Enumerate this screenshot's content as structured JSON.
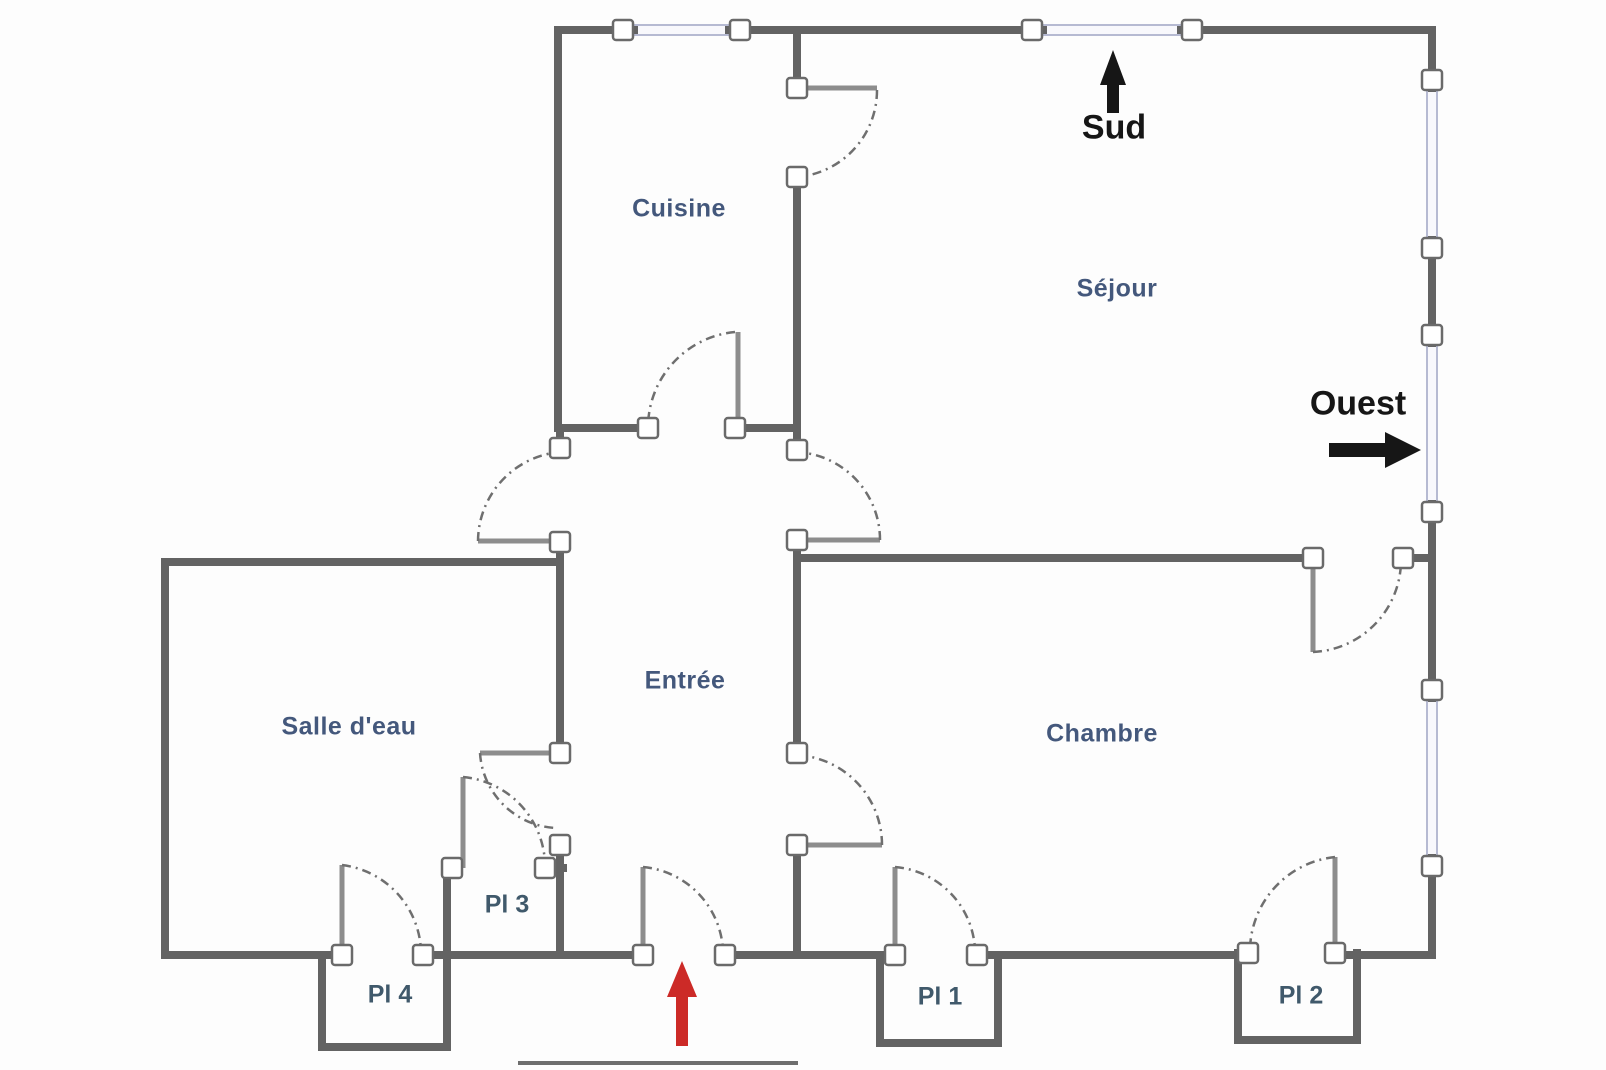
{
  "plan_title": "Apartment floor plan",
  "rooms": {
    "cuisine": "Cuisine",
    "sejour": "Séjour",
    "salle_eau": "Salle d'eau",
    "entree": "Entrée",
    "chambre": "Chambre"
  },
  "closets": {
    "pl1": "Pl 1",
    "pl2": "Pl 2",
    "pl3": "Pl 3",
    "pl4": "Pl 4"
  },
  "compass": {
    "south": "Sud",
    "west": "Ouest"
  },
  "colors": {
    "wall": "#636363",
    "door_leaf": "#8d8d8d",
    "door_arc": "#6f6f6f",
    "window_frame": "#b6bad2",
    "window_fill": "#f8f8fc",
    "junction_fill": "#ffffff",
    "room_label": "#44587c",
    "closet_label": "#40596b",
    "compass_label": "#161616",
    "entrance_arrow": "#cc2a27"
  }
}
